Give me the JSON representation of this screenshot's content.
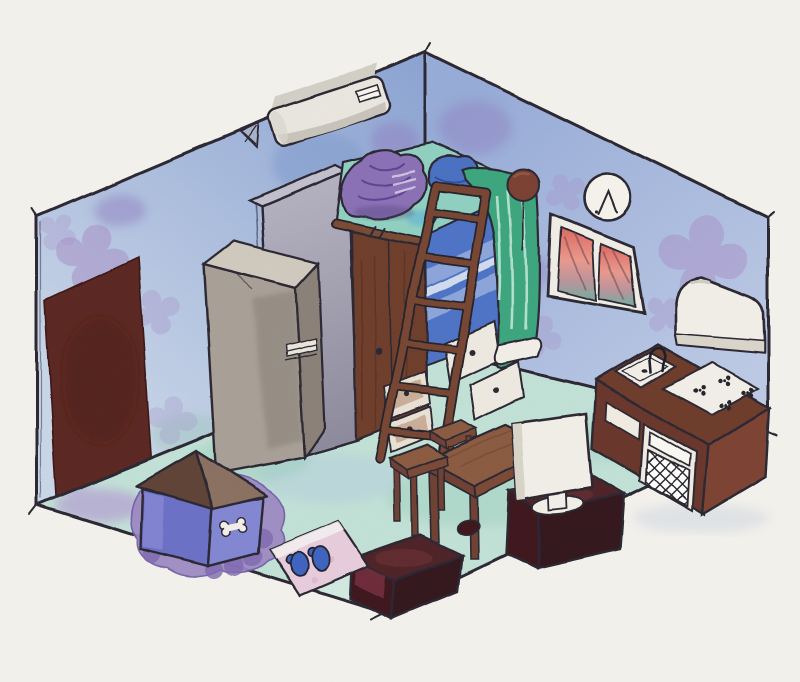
{
  "artwork": {
    "title": "Watercolor isometric tiny-room illustration",
    "style": "hand-drawn watercolor and ink sketch",
    "description": "Cutaway isometric view of a small studio room: blue flowered walls, mint floor, loft bed with ladder and wardrobe, kitchen counter with sink and stove, refrigerator, door, window with sunset, dog house with bone, TV on stand, low table with stools, slippers on a mat."
  },
  "objects": [
    {
      "id": "door",
      "label": "entry door"
    },
    {
      "id": "air-conditioner",
      "label": "wall air conditioner"
    },
    {
      "id": "refrigerator",
      "label": "refrigerator"
    },
    {
      "id": "partition-wall",
      "label": "loft partition wall"
    },
    {
      "id": "loft-bed",
      "label": "loft bed platform"
    },
    {
      "id": "blanket-pile",
      "label": "purple folded blankets"
    },
    {
      "id": "pillow",
      "label": "blue cushion"
    },
    {
      "id": "ladder",
      "label": "wooden ladder"
    },
    {
      "id": "wardrobe",
      "label": "wardrobe with drawers"
    },
    {
      "id": "bedding",
      "label": "blue striped bedding"
    },
    {
      "id": "under-bed-drawers",
      "label": "white under-bed drawers"
    },
    {
      "id": "curtain",
      "label": "green curtain"
    },
    {
      "id": "hanging-ornament",
      "label": "hanging brown ornament"
    },
    {
      "id": "wall-clock",
      "label": "round wall clock"
    },
    {
      "id": "window",
      "label": "window with sunset view"
    },
    {
      "id": "range-hood",
      "label": "white range hood"
    },
    {
      "id": "kitchen-counter",
      "label": "kitchen counter with sink, stove and oven"
    },
    {
      "id": "low-table",
      "label": "low wooden table"
    },
    {
      "id": "stool",
      "label": "wooden stools"
    },
    {
      "id": "tv-monitor",
      "label": "white monitor"
    },
    {
      "id": "tv-stand",
      "label": "dark tv stand"
    },
    {
      "id": "ottoman",
      "label": "dark ottoman box"
    },
    {
      "id": "floor-mat",
      "label": "pink mat"
    },
    {
      "id": "slippers",
      "label": "blue slippers"
    },
    {
      "id": "dog-house",
      "label": "dog house with tent roof"
    },
    {
      "id": "bone",
      "label": "bone motif"
    },
    {
      "id": "pet-rug",
      "label": "purple pet rug"
    }
  ],
  "colors": {
    "paper": "#f4f2ec",
    "ink": "#2a2731",
    "wall_left_top": "#8aa2d2",
    "wall_left_bottom": "#c9d6e8",
    "wall_right_top": "#96abd7",
    "wall_right_bottom": "#bdcae5",
    "flower": "#a78fc8",
    "wall_blotch": "#8f7fc0",
    "wall_teal": "#9fc8c0",
    "floor": "#c2e1d6",
    "floor_teal": "#93cbb9",
    "floor_lavender": "#b4a1d2",
    "floor_blue": "#a9c0e2",
    "floor_pale": "#dcefe6",
    "door": "#5a2620",
    "fridge_front": "#a89f96",
    "fridge_top": "#d0c9be",
    "fridge_side": "#8a8078",
    "fridge_handle": "#eae5db",
    "partition_top": "#c2bfcd",
    "ac_body": "#e9e6df",
    "ac_shade": "#c8c4bb",
    "bracket": "#a7b2cc",
    "clock_face": "#f5f3ec",
    "window_frame": "#f0ede5",
    "sunset_top": "#dd665e",
    "sunset_mid": "#e9998c",
    "sunset_teal": "#6fae9f",
    "hood": "#f2efe7",
    "hood_shade": "#d9d5ca",
    "counter_top": "#6d3a2b",
    "counter_front": "#68362a",
    "counter_side": "#7c4331",
    "stove": "#f2efe8",
    "sink": "#f2efe8",
    "oven_panel": "#f0ece2",
    "deck": "#8fd0c0",
    "beam": "#7a4a33",
    "blanket": "#8a6fb5",
    "blanket_fold": "#5d4390",
    "pillow": "#4a6fc2",
    "curtain": "#3aa57e",
    "curtain_streak": "#cfeee2",
    "tube": "#f2efe8",
    "ornament": "#7a4030",
    "bedding": "#4e73c6",
    "bedding_stripe": "#93aadd",
    "wardrobe": "#6e3d2c",
    "drawer_face": "#e8e1d4",
    "ladder": "#764531",
    "wood": "#8a5a40",
    "wood_dark": "#6e4130",
    "tv": "#f2efe8",
    "tv_shade": "#d9d4c8",
    "maroon_top": "#4e2326",
    "maroon_front": "#3d191c",
    "maroon_side": "#33141a",
    "maroon_patch": "#7e3340",
    "rug": "#9b87c2",
    "rug_dark": "#7e68b0",
    "doghouse_front": "#6b6fc6",
    "doghouse_side": "#8286d2",
    "doghouse_hl": "#8d90d8",
    "roof_dark": "#5e4336",
    "roof_light": "#8a7060",
    "bone": "#f2efe8",
    "mat": "#e7cddc",
    "mat_band": "#f4eef0",
    "slipper": "#3d63c0"
  }
}
